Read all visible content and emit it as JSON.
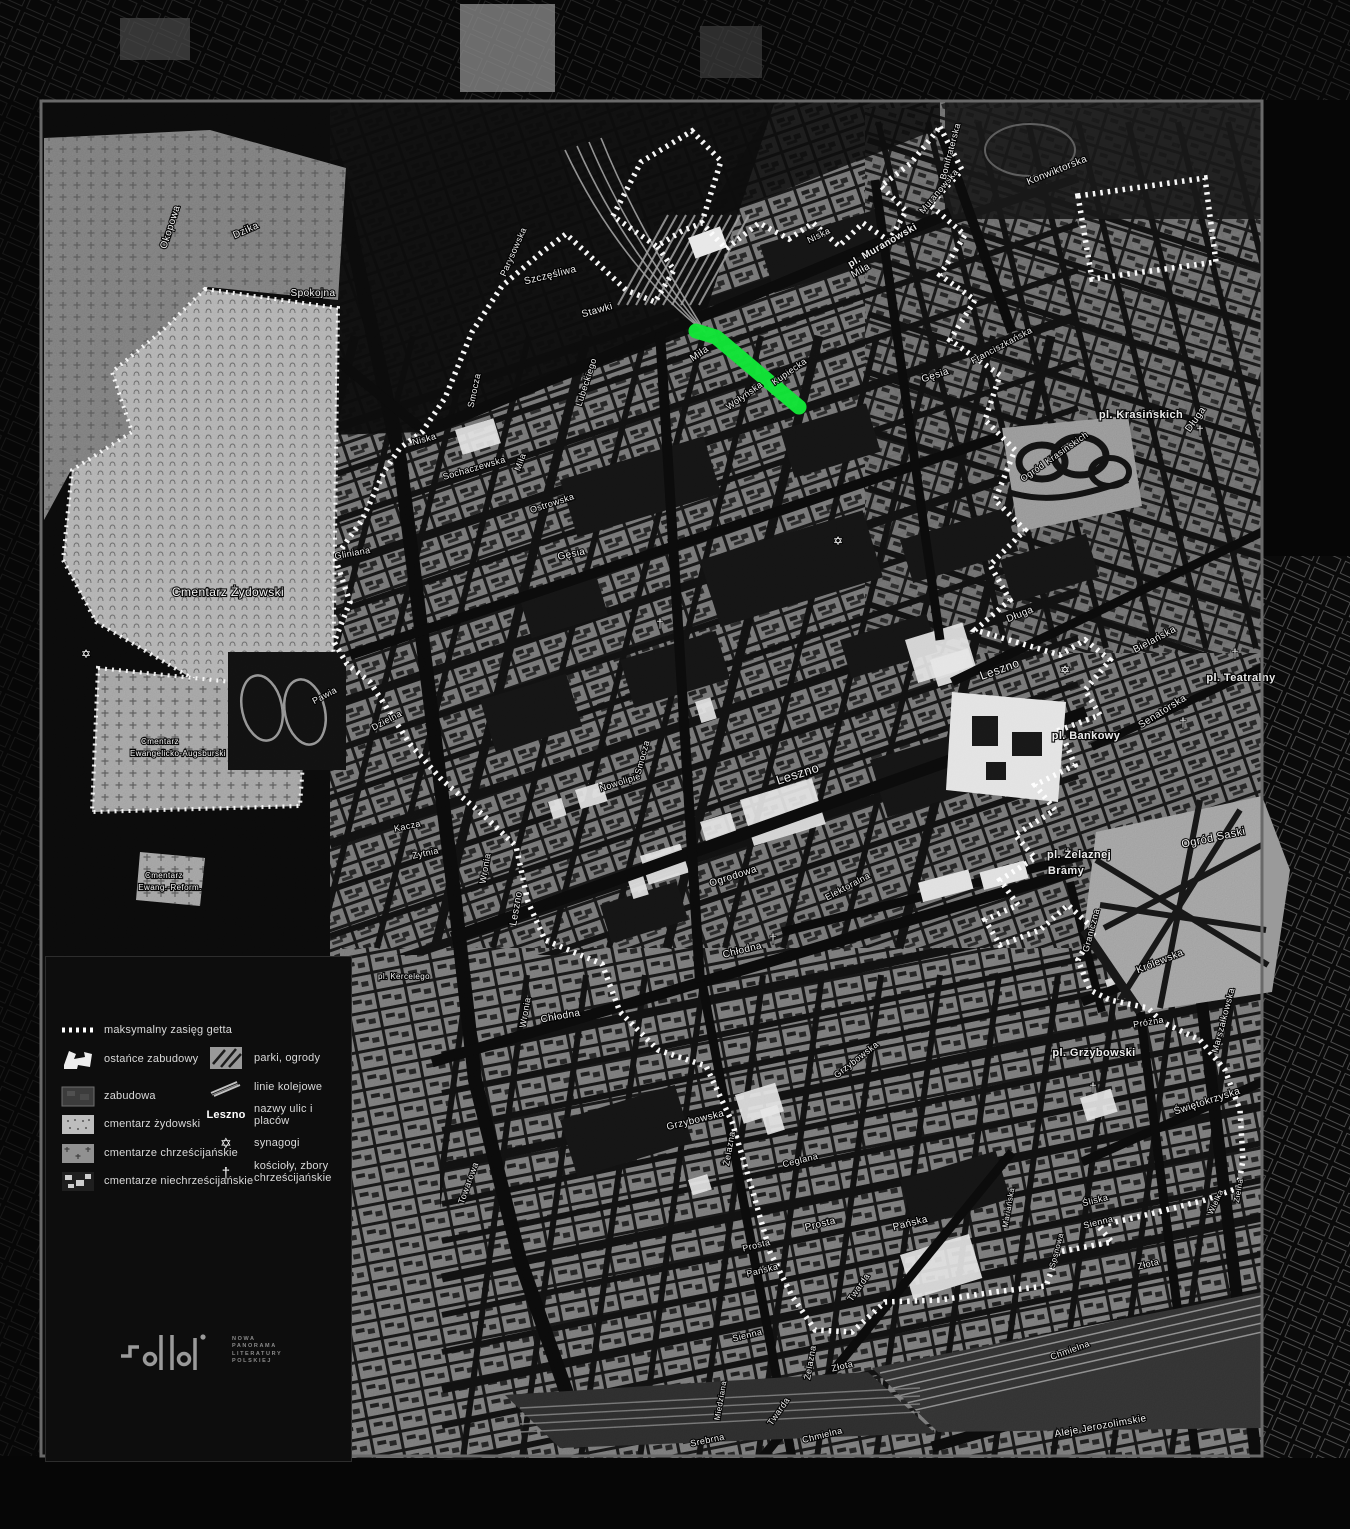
{
  "page": {
    "background": "#060606",
    "frame_color": "#696969"
  },
  "map": {
    "highlight": {
      "color": "#10e232",
      "description": "highlighted street segment"
    },
    "boundary_color": "#ffffff",
    "labels": [
      [
        "Okopowa",
        173,
        228,
        -72,
        10,
        0
      ],
      [
        "Dzika",
        247,
        233,
        -24,
        10,
        0
      ],
      [
        "Spokojna",
        313,
        296,
        0,
        10,
        0
      ],
      [
        "Parysowska",
        516,
        253,
        -66,
        9,
        0
      ],
      [
        "Szczęśliwa",
        551,
        278,
        -14,
        10,
        0
      ],
      [
        "Stawki",
        598,
        313,
        -16,
        10,
        0
      ],
      [
        "Smocza",
        477,
        391,
        -78,
        9,
        0
      ],
      [
        "Lubeckiego",
        589,
        383,
        -72,
        9,
        0
      ],
      [
        "Niska",
        425,
        442,
        -16,
        9,
        0
      ],
      [
        "Niska",
        820,
        238,
        -26,
        9,
        0
      ],
      [
        "Sochaczewska",
        475,
        471,
        -16,
        9,
        0
      ],
      [
        "Miła",
        523,
        463,
        -70,
        9,
        0
      ],
      [
        "Miła",
        701,
        356,
        -34,
        10,
        0
      ],
      [
        "Miła",
        862,
        273,
        -30,
        10,
        0
      ],
      [
        "Ostrowska",
        553,
        506,
        -18,
        9,
        0
      ],
      [
        "Gęsia",
        572,
        557,
        -12,
        10,
        0
      ],
      [
        "Gęsia",
        936,
        378,
        -18,
        10,
        0
      ],
      [
        "Gliniana",
        353,
        556,
        -10,
        9,
        0
      ],
      [
        "Pawia",
        326,
        698,
        -28,
        9,
        0
      ],
      [
        "Dzielna",
        388,
        723,
        -28,
        9,
        0
      ],
      [
        "Wołyńska",
        746,
        398,
        -35,
        9,
        0
      ],
      [
        "Kupiecka",
        791,
        374,
        -35,
        9,
        0
      ],
      [
        "Muranowska",
        941,
        193,
        -50,
        9,
        0
      ],
      [
        "Bonifraterska",
        953,
        152,
        -75,
        9,
        0
      ],
      [
        "Konwiktorska",
        1058,
        173,
        -22,
        10,
        0
      ],
      [
        "Franciszkańska",
        1003,
        348,
        -28,
        9,
        0
      ],
      [
        "Długa",
        1198,
        421,
        -55,
        10,
        0
      ],
      [
        "Długa",
        1021,
        617,
        -22,
        10,
        0
      ],
      [
        "Bielańska",
        1156,
        642,
        -28,
        10,
        0
      ],
      [
        "Senatorska",
        1164,
        714,
        -32,
        10,
        0
      ],
      [
        "pl. Teatralny",
        1241,
        681,
        0,
        11,
        1
      ],
      [
        "pl. Bankowy",
        1086,
        739,
        0,
        11,
        1
      ],
      [
        "pl. Krasińskich",
        1141,
        418,
        0,
        11,
        1
      ],
      [
        "pl. Muranowski",
        884,
        248,
        -30,
        10,
        1
      ],
      [
        "Ogród Krasińskich",
        1056,
        459,
        -35,
        9,
        0
      ],
      [
        "Ogród Saski",
        1214,
        841,
        -12,
        11,
        0
      ],
      [
        "pl. Żelaznej",
        1079,
        858,
        0,
        11,
        1
      ],
      [
        "Bramy",
        1066,
        874,
        0,
        11,
        1
      ],
      [
        "pl. Grzybowski",
        1094,
        1056,
        0,
        11,
        1
      ],
      [
        "pl. Kercelego",
        404,
        979,
        0,
        8,
        0
      ],
      [
        "Leszno",
        1001,
        673,
        -20,
        12,
        0
      ],
      [
        "Leszno",
        799,
        778,
        -18,
        13,
        0
      ],
      [
        "Leszno",
        519,
        909,
        -80,
        10,
        0
      ],
      [
        "Nowolipie",
        621,
        785,
        -18,
        9,
        0
      ],
      [
        "Smocza",
        645,
        758,
        -75,
        9,
        0
      ],
      [
        "Ogrodowa",
        734,
        879,
        -18,
        10,
        0
      ],
      [
        "Elektoralna",
        849,
        889,
        -28,
        9,
        0
      ],
      [
        "Chłodna",
        743,
        953,
        -14,
        10,
        0
      ],
      [
        "Chłodna",
        561,
        1019,
        -10,
        10,
        0
      ],
      [
        "Żytnia",
        426,
        856,
        -12,
        9,
        0
      ],
      [
        "Kacza",
        408,
        829,
        -12,
        9,
        0
      ],
      [
        "Wronia",
        488,
        869,
        -80,
        9,
        0
      ],
      [
        "Wronia",
        528,
        1013,
        -80,
        9,
        0
      ],
      [
        "Towarowa",
        471,
        1184,
        -70,
        9,
        0
      ],
      [
        "Grzybowska",
        696,
        1123,
        -14,
        10,
        0
      ],
      [
        "Grzybowska",
        858,
        1062,
        -38,
        9,
        0
      ],
      [
        "Żelazna",
        732,
        1149,
        -80,
        9,
        0
      ],
      [
        "Żelazna",
        813,
        1363,
        -80,
        9,
        0
      ],
      [
        "Ceglana",
        801,
        1163,
        -14,
        9,
        0
      ],
      [
        "Prosta",
        821,
        1227,
        -14,
        10,
        0
      ],
      [
        "Prosta",
        757,
        1248,
        -14,
        9,
        0
      ],
      [
        "Pańska",
        911,
        1226,
        -14,
        10,
        0
      ],
      [
        "Pańska",
        763,
        1273,
        -14,
        9,
        0
      ],
      [
        "Twarda",
        861,
        1289,
        -55,
        9,
        0
      ],
      [
        "Twarda",
        781,
        1413,
        -55,
        9,
        0
      ],
      [
        "Mariańska",
        1011,
        1208,
        -80,
        8,
        0
      ],
      [
        "Śliska",
        1096,
        1203,
        -14,
        9,
        0
      ],
      [
        "Sienna",
        1099,
        1225,
        -14,
        9,
        0
      ],
      [
        "Sienna",
        748,
        1338,
        -14,
        9,
        0
      ],
      [
        "Złota",
        1149,
        1267,
        -14,
        9,
        0
      ],
      [
        "Złota",
        843,
        1369,
        -14,
        9,
        0
      ],
      [
        "Sosnowa",
        1059,
        1251,
        -75,
        8,
        0
      ],
      [
        "Wielka",
        1218,
        1203,
        -65,
        8,
        0
      ],
      [
        "Zielna",
        1241,
        1191,
        -80,
        8,
        0
      ],
      [
        "Świętokrzyska",
        1208,
        1104,
        -18,
        10,
        0
      ],
      [
        "Próżna",
        1149,
        1025,
        -10,
        9,
        0
      ],
      [
        "Graniczna",
        1094,
        931,
        -75,
        9,
        0
      ],
      [
        "Królewska",
        1161,
        964,
        -22,
        10,
        0
      ],
      [
        "Marszałkowska",
        1226,
        1021,
        -75,
        9,
        0
      ],
      [
        "Miedziana",
        723,
        1401,
        -80,
        8,
        0
      ],
      [
        "Srebrna",
        708,
        1443,
        -12,
        9,
        0
      ],
      [
        "Chmielna",
        823,
        1438,
        -14,
        9,
        0
      ],
      [
        "Chmielna",
        1071,
        1353,
        -20,
        9,
        0
      ],
      [
        "Aleje Jerozolimskie",
        1101,
        1429,
        -10,
        10,
        0
      ],
      [
        "Cmentarz Żydowski",
        228,
        596,
        0,
        12,
        0
      ],
      [
        "Cmentarz",
        160,
        744,
        0,
        8,
        0
      ],
      [
        "Ewangelicko-Augsburski",
        178,
        756,
        0,
        8,
        0
      ],
      [
        "Cmentarz",
        164,
        878,
        0,
        8,
        0
      ],
      [
        "Ewang.-Reform.",
        170,
        890,
        0,
        8,
        0
      ]
    ],
    "symbols": {
      "synagogues": [
        [
          838,
          545
        ],
        [
          1065,
          674
        ],
        [
          86,
          658
        ]
      ],
      "churches": [
        [
          660,
          628
        ],
        [
          1200,
          435
        ],
        [
          1235,
          658
        ],
        [
          1183,
          727
        ],
        [
          773,
          943
        ],
        [
          1093,
          1092
        ]
      ]
    }
  },
  "legend": {
    "left": [
      {
        "key": "ghetto",
        "label": "maksymalny zasięg getta"
      },
      {
        "key": "ostance",
        "label": "ostańce zabudowy"
      },
      {
        "key": "zabudowa",
        "label": "zabudowa"
      },
      {
        "key": "cemj",
        "label": "cmentarz żydowski"
      },
      {
        "key": "cemc",
        "label": "cmentarze chrześcijańskie"
      },
      {
        "key": "cemn",
        "label": "cmentarze niechrześcijańskie"
      }
    ],
    "right": [
      {
        "key": "park",
        "label": "parki, ogrody"
      },
      {
        "key": "rail",
        "label": "linie kolejowe"
      },
      {
        "key": "names",
        "sample": "Leszno",
        "label": "nazwy ulic i placów"
      },
      {
        "key": "syn",
        "label": "synagogi"
      },
      {
        "key": "church",
        "label": "kościoły, zbory\nchrześcijańskie"
      }
    ]
  },
  "logo": {
    "caption": [
      "NOWA",
      "PANORAMA",
      "LITERATURY",
      "POLSKIEJ"
    ]
  }
}
